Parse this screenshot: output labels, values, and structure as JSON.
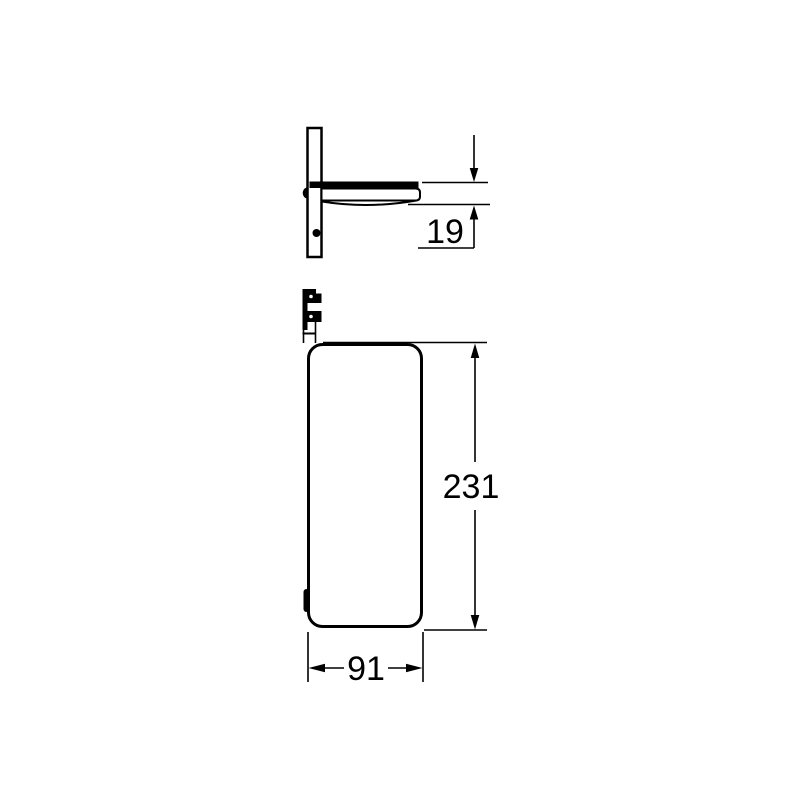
{
  "page": {
    "background_color": "#ffffff",
    "line_color": "#000000"
  },
  "drawing": {
    "type": "technical-dimension-drawing",
    "views": {
      "side_view": "wall-mounted shelf side profile",
      "front_view": "shelf front elevation"
    },
    "dimensions": {
      "depth": "19",
      "height": "231",
      "width": "91"
    }
  }
}
